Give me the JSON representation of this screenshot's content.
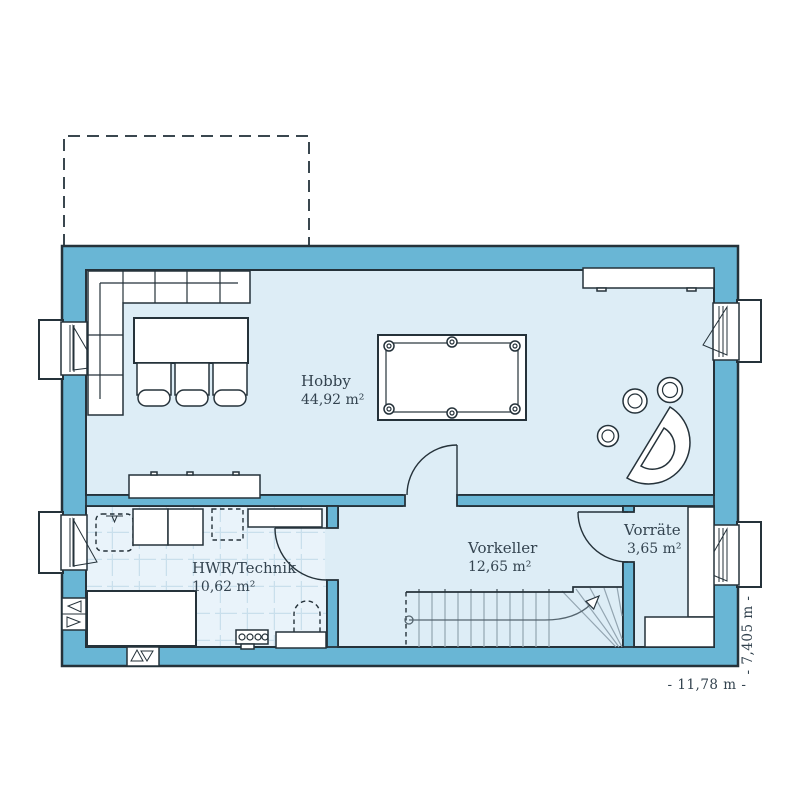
{
  "plan": {
    "rooms": [
      {
        "name": "Hobby",
        "area": "44,92 m²"
      },
      {
        "name": "HWR/Technik",
        "area": "10,62 m²"
      },
      {
        "name": "Vorkeller",
        "area": "12,65 m²"
      },
      {
        "name": "Vorräte",
        "area": "3,65 m²"
      }
    ],
    "dimensions": {
      "width_label": "- 11,78 m -",
      "depth_label": "- 7,405 m -"
    }
  },
  "colors": {
    "wall": "#69b6d5",
    "floor": "#ddedf6",
    "tile_floor": "#e9f3fa",
    "tile_line": "#c9dfec",
    "outline": "#25323a",
    "furniture": "#ffffff",
    "label_text": "#33434f",
    "stair_line": "#93a5b1"
  },
  "elements": [
    "terrace-outline",
    "corner-sofa",
    "dining-table",
    "dining-chairs",
    "billiard-table",
    "sideboard",
    "drum-kit",
    "interior-door",
    "laundry-sink",
    "washing-machine",
    "dryer",
    "planned-appliance-outline",
    "wall-shelf",
    "work-table",
    "distribution-manifold",
    "heating-tank",
    "staircase-with-winders",
    "storage-shelf",
    "window-light-well",
    "ventilation-grille"
  ]
}
